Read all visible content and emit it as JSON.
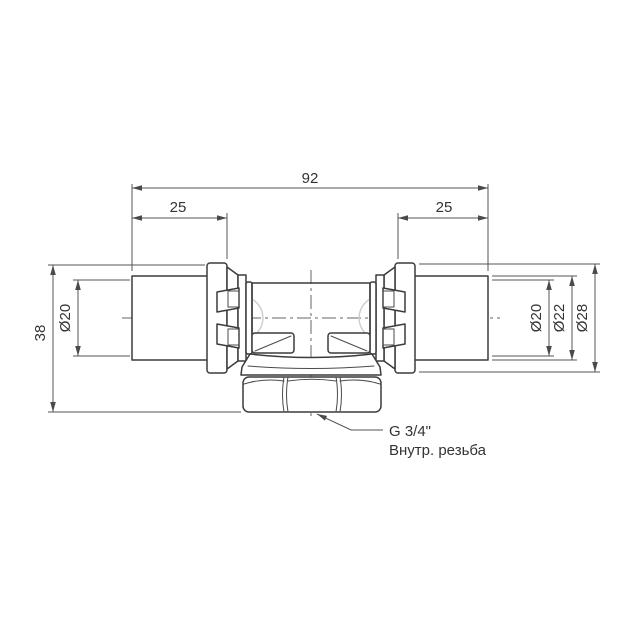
{
  "drawing": {
    "dimensions": {
      "overall_width": "92",
      "insert_left": "25",
      "insert_right": "25",
      "height": "38",
      "bore_left": "Ø20",
      "bore_right": "Ø20",
      "sleeve_od": "Ø22",
      "collar_od": "Ø28"
    },
    "annotation": {
      "thread": "G 3/4\"",
      "thread_note": "Внутр. резьба"
    },
    "colors": {
      "background": "#ffffff",
      "part_line": "#3c3c3c",
      "dimension_line": "#555555",
      "centerline": "#666666",
      "shading_hint": "#cccccc",
      "text": "#333333"
    }
  }
}
